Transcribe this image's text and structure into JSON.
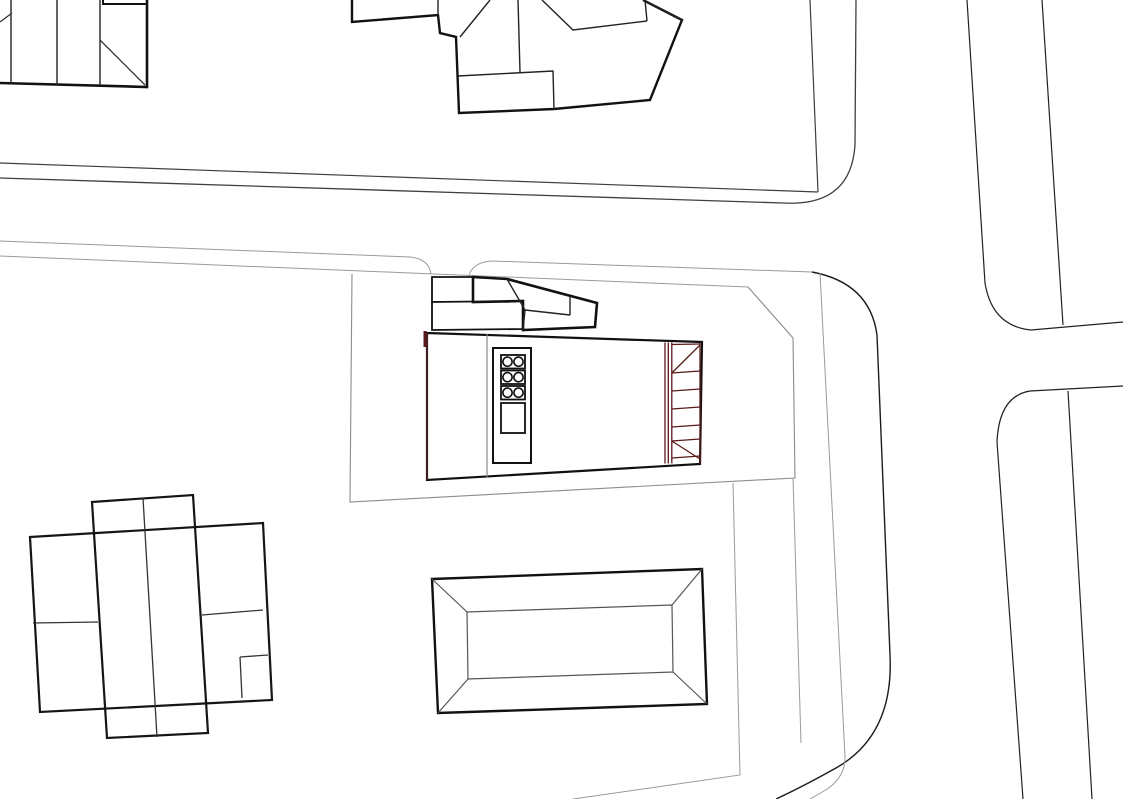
{
  "canvas": {
    "width": 1123,
    "height": 799,
    "background": "#ffffff"
  },
  "palette": {
    "ink": "#111111",
    "dark_line": "#3f3f3f",
    "road_line": "#222222",
    "gray_line": "#9a9a9a",
    "mid_gray": "#8c8c8c",
    "maroon": "#5a1a1a",
    "dark_maroon_edge": "#4a2323",
    "white": "#ffffff"
  },
  "drawing": {
    "layers": [
      {
        "name": "roads-and-parcels",
        "shapes": [
          {
            "name": "north-block-inner-edge",
            "type": "path",
            "d": "M0,163 L818,192",
            "stroke": "#3f3f3f",
            "width": 1.2
          },
          {
            "name": "north-block-side-edge",
            "type": "path",
            "d": "M810,0 L818,192",
            "stroke": "#3f3f3f",
            "width": 1.2
          },
          {
            "name": "north-block-curb",
            "type": "path",
            "d": "M0,178 L783,203 Q851,207 855,145 L856,0",
            "stroke": "#3f3f3f",
            "width": 1.3
          },
          {
            "name": "south-curb-west",
            "type": "path",
            "d": "M0,241 L410,257 Q429,259 431,274",
            "stroke": "#9a9a9a",
            "width": 1
          },
          {
            "name": "south-sidewalk-line",
            "type": "path",
            "d": "M0,256 L748,287",
            "stroke": "#9a9a9a",
            "width": 1
          },
          {
            "name": "driveway-east-fillet",
            "type": "path",
            "d": "M468,279 Q471,262 492,261",
            "stroke": "#9a9a9a",
            "width": 1
          },
          {
            "name": "south-curb-east",
            "type": "path",
            "d": "M492,261 L812,272",
            "stroke": "#9a9a9a",
            "width": 1
          },
          {
            "name": "corner-curve-outer",
            "type": "path",
            "d": "M812,272 Q870,283 877,335 L890,655 Q894,735 836,768 Q802,787 776,799",
            "stroke": "#1c1c1c",
            "width": 1.4
          },
          {
            "name": "corner-curve-inner",
            "type": "path",
            "d": "M820,273 L845,757 Q845,779 824,791 L810,799",
            "stroke": "#9a9a9a",
            "width": 1
          },
          {
            "name": "parcel-boundary",
            "type": "path",
            "d": "M352,274 L350,502 L795,478 L793,338 L748,287",
            "stroke": "#8c8c8c",
            "width": 1.1
          },
          {
            "name": "lot-line-east",
            "type": "path",
            "d": "M793,478 L801,743",
            "stroke": "#9a9a9a",
            "width": 1
          },
          {
            "name": "lot-line-mid",
            "type": "path",
            "d": "M733,483 L740,775 L573,799",
            "stroke": "#9a9a9a",
            "width": 1
          },
          {
            "name": "east-road-west-edge",
            "type": "path",
            "d": "M967,0 L985,283 Q992,326 1031,330 L1123,322",
            "stroke": "#222222",
            "width": 1.2
          },
          {
            "name": "east-road-east-edge",
            "type": "path",
            "d": "M1042,0 L1063,325",
            "stroke": "#222222",
            "width": 1.2
          },
          {
            "name": "southeast-block-edge",
            "type": "path",
            "d": "M1123,386 L1030,391 Q999,396 997,442 L1023,799",
            "stroke": "#222222",
            "width": 1.2
          },
          {
            "name": "southeast-block-inner",
            "type": "path",
            "d": "M1068,391 L1092,799",
            "stroke": "#222222",
            "width": 1.2
          }
        ]
      },
      {
        "name": "neighbor-buildings",
        "shapes": [
          {
            "name": "northwest-building-outline",
            "type": "path",
            "d": "M0,83 L147,87 L147,0",
            "stroke": "#111111",
            "width": 2.6
          },
          {
            "name": "northwest-building-partitions",
            "type": "path",
            "d": "M11,0 L11,84 M57,0 L57,85 M100,0 L100,86",
            "stroke": "#222222",
            "width": 1.4
          },
          {
            "name": "northwest-building-notch",
            "type": "path",
            "d": "M103,0 L103,4 L147,4",
            "stroke": "#111111",
            "width": 2
          },
          {
            "name": "northwest-building-diagonals",
            "type": "path",
            "d": "M100,40 L145,85 M0,22 L12,13",
            "stroke": "#333333",
            "width": 1.3
          },
          {
            "name": "north-house-outline",
            "type": "path",
            "d": "M352,0 L352,22 L438,15 L440,33 L456,37 L459,113 L554,109 L650,100 L682,20 L643,0",
            "stroke": "#111111",
            "width": 2.4
          },
          {
            "name": "north-house-roof-lines",
            "type": "path",
            "d": "M438,0 L438,15 M458,76 L553,71 L554,109 M518,0 L520,72 M490,0 L460,37 M542,0 L573,30 L647,21 M645,0 L647,21 M643,0 L682,20",
            "stroke": "#222222",
            "width": 1.4
          },
          {
            "name": "southwest-building-wide-rect",
            "type": "polygon",
            "points": "30,537 263,523 272,700 40,712",
            "stroke": "#151515",
            "width": 2.2
          },
          {
            "name": "southwest-building-tall-rect",
            "type": "polygon",
            "points": "92,502 193,495 208,733 107,738",
            "stroke": "#151515",
            "width": 2.2
          },
          {
            "name": "southwest-building-inner-lines",
            "type": "path",
            "d": "M143,498 L157,737 M33,623 L98,622 M202,615 L263,610 M240,657 L268,655 M240,657 L242,698",
            "stroke": "#333333",
            "width": 1.3
          },
          {
            "name": "pool-outer-rect",
            "type": "polygon",
            "points": "432,579 702,569 707,704 438,713",
            "stroke": "#111111",
            "width": 2.4,
            "fill": "#ffffff"
          },
          {
            "name": "pool-inner-rect",
            "type": "polygon",
            "points": "467,612 672,605 673,672 468,679",
            "stroke": "#555555",
            "width": 1.2
          },
          {
            "name": "pool-corner-diagonals",
            "type": "path",
            "d": "M432,579 L467,612 M702,569 L672,605 M707,704 L673,672 M438,713 L468,679",
            "stroke": "#555555",
            "width": 1.2
          }
        ]
      },
      {
        "name": "main-building",
        "shapes": [
          {
            "name": "canopy-rect-west",
            "type": "polygon",
            "points": "432,277 473,277 473,302 432,302",
            "stroke": "#111111",
            "width": 1.8,
            "fill": "#ffffff"
          },
          {
            "name": "canopy-rect-south",
            "type": "polygon",
            "points": "432,302 523,301 523,329 432,330",
            "stroke": "#111111",
            "width": 1.8,
            "fill": "#ffffff"
          },
          {
            "name": "canopy-folded-strip",
            "type": "polygon",
            "points": "473,277 507,279 597,303 595,327 523,330 523,301 473,302",
            "stroke": "#111111",
            "width": 2.6,
            "fill": "#ffffff"
          },
          {
            "name": "canopy-fold-lines",
            "type": "path",
            "d": "M570,296 L570,315 M570,315 L525,310 M507,279 L525,310 M525,310 L523,330",
            "stroke": "#222222",
            "width": 1.4
          },
          {
            "name": "building-body",
            "type": "polygon",
            "points": "427,333 702,342 700,464 427,480",
            "stroke": "#111111",
            "width": 2.2,
            "fill": "#ffffff"
          },
          {
            "name": "building-west-edge",
            "type": "path",
            "d": "M427,333 L427,480",
            "stroke": "#4a2323",
            "width": 1.6
          },
          {
            "name": "building-west-red-tick",
            "type": "path",
            "d": "M425,331 L425,347",
            "stroke": "#5a1a1a",
            "width": 3
          },
          {
            "name": "building-interior-divider",
            "type": "path",
            "d": "M487,334 L487,478",
            "stroke": "#8a8a8a",
            "width": 1.2
          },
          {
            "name": "core-rect",
            "type": "rect",
            "x": 493,
            "y": 348,
            "w": 38,
            "h": 115,
            "stroke": "#111111",
            "width": 2,
            "fill": "#ffffff"
          },
          {
            "name": "stove-box-1",
            "type": "rect",
            "x": 501,
            "y": 355,
            "w": 24,
            "h": 13.5,
            "stroke": "#111111",
            "width": 1.8
          },
          {
            "name": "stove-box-2",
            "type": "rect",
            "x": 501,
            "y": 370.5,
            "w": 24,
            "h": 13.5,
            "stroke": "#111111",
            "width": 1.8
          },
          {
            "name": "stove-box-3",
            "type": "rect",
            "x": 501,
            "y": 386,
            "w": 24,
            "h": 13.5,
            "stroke": "#111111",
            "width": 1.8
          },
          {
            "name": "burner-circle-1a",
            "type": "circle",
            "cx": 507.5,
            "cy": 361.7,
            "r": 4.6,
            "stroke": "#111111",
            "width": 1.6
          },
          {
            "name": "burner-circle-1b",
            "type": "circle",
            "cx": 518.5,
            "cy": 361.7,
            "r": 4.6,
            "stroke": "#111111",
            "width": 1.6
          },
          {
            "name": "burner-circle-2a",
            "type": "circle",
            "cx": 507.5,
            "cy": 377.2,
            "r": 4.6,
            "stroke": "#111111",
            "width": 1.6
          },
          {
            "name": "burner-circle-2b",
            "type": "circle",
            "cx": 518.5,
            "cy": 377.2,
            "r": 4.6,
            "stroke": "#111111",
            "width": 1.6
          },
          {
            "name": "burner-circle-3a",
            "type": "circle",
            "cx": 507.5,
            "cy": 392.7,
            "r": 4.6,
            "stroke": "#111111",
            "width": 1.6
          },
          {
            "name": "burner-circle-3b",
            "type": "circle",
            "cx": 518.5,
            "cy": 392.7,
            "r": 4.6,
            "stroke": "#111111",
            "width": 1.6
          },
          {
            "name": "core-door-rect",
            "type": "rect",
            "x": 501,
            "y": 403,
            "w": 24,
            "h": 30,
            "stroke": "#111111",
            "width": 1.8
          }
        ]
      },
      {
        "name": "red-trellis",
        "shapes": [
          {
            "name": "trellis-verticals",
            "type": "path",
            "d": "M665,342.5 L665,463.5 M668.3,342.5 L668.3,463.5 M671.8,342.5 L671.8,463.5 M700,342.5 L700,463.5",
            "stroke": "#5a1a1a",
            "width": 1.3
          },
          {
            "name": "trellis-rungs",
            "type": "path",
            "d": "M671.8,344.5 L700,344 M671.8,373 L700,371 M671.8,391 L700,389 M671.8,409 L700,407 M671.8,427 L700,425 M671.8,441 L700,439 M671.8,458 L700,456",
            "stroke": "#5a1a1a",
            "width": 1.3
          },
          {
            "name": "trellis-diagonals",
            "type": "path",
            "d": "M671.8,373 L700,345 M671.8,441 L700,459",
            "stroke": "#5a1a1a",
            "width": 1.3
          }
        ]
      }
    ]
  }
}
